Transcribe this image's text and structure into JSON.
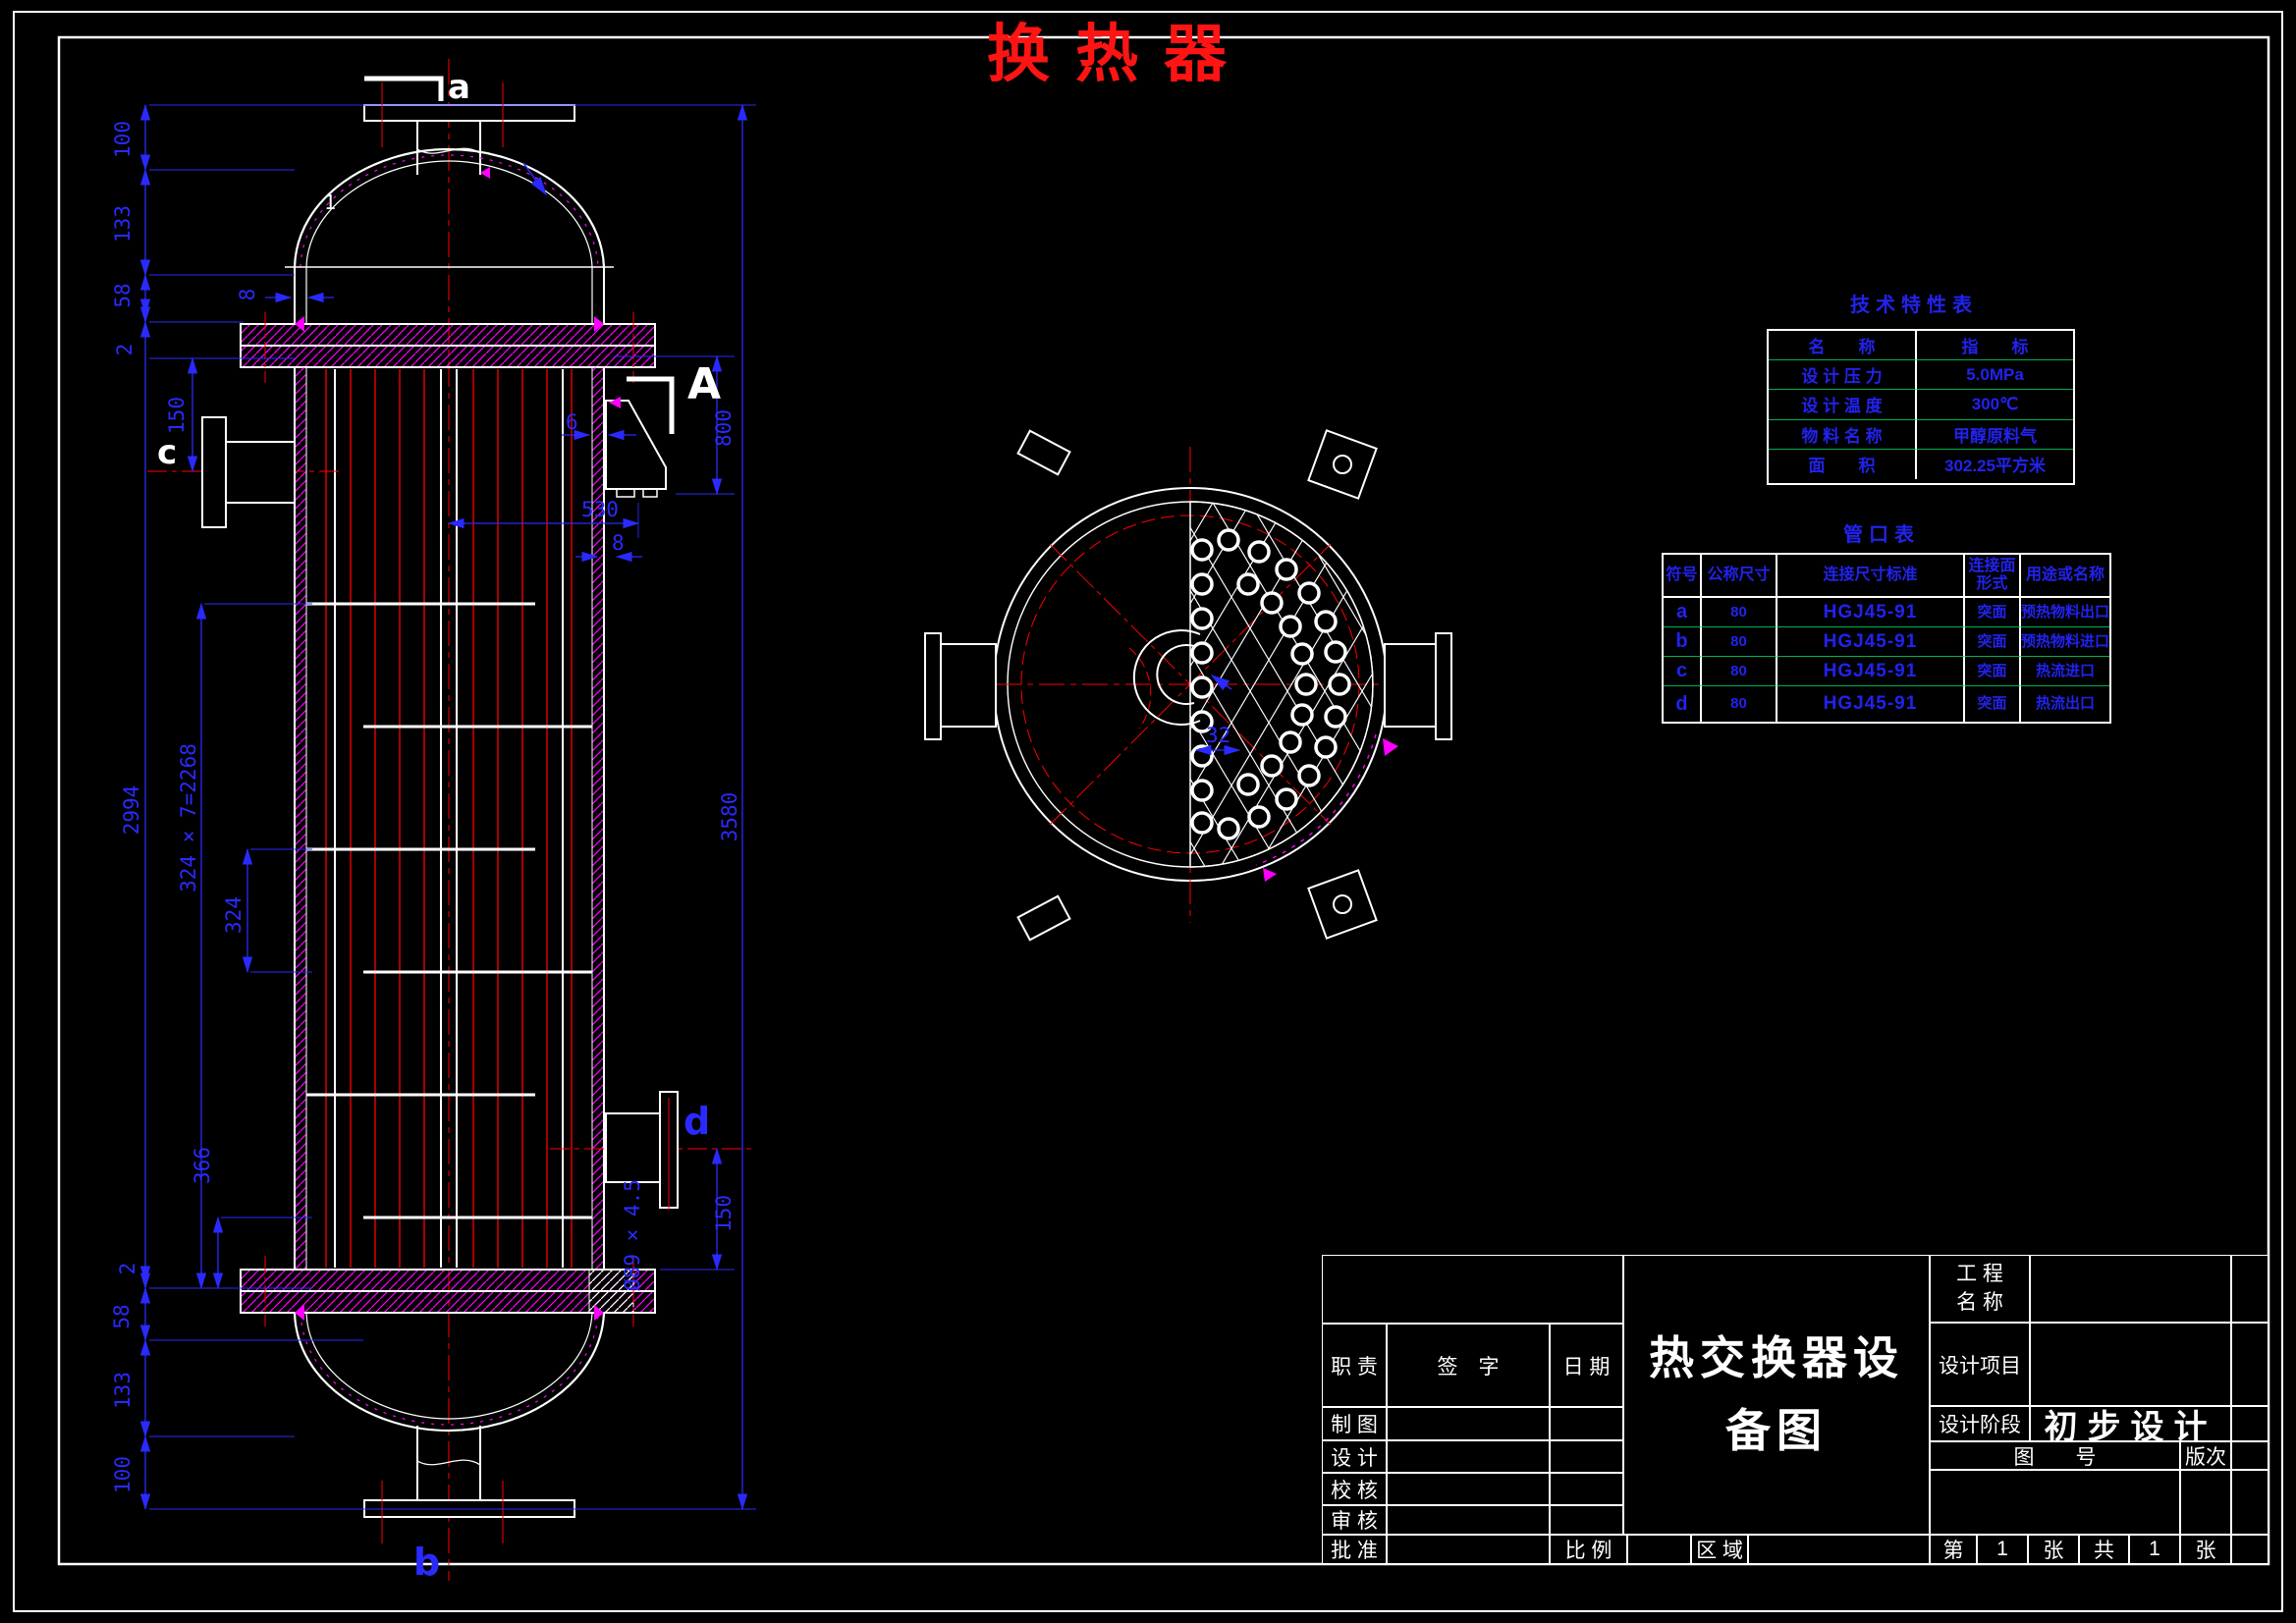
{
  "page_title": "换热器",
  "colors": {
    "line": "#ffffff",
    "dimension": "#2a2aff",
    "centerline": "#ff0000",
    "hatch": "#ff00ff",
    "table_grid": "#00b050",
    "main_title": "#ff1414",
    "table_text": "#2222ee"
  },
  "tech_table": {
    "title": "技术特性表",
    "col_headers": [
      "名　　称",
      "指　　标"
    ],
    "rows": [
      [
        "设 计 压 力",
        "5.0MPa"
      ],
      [
        "设 计 温 度",
        "300℃"
      ],
      [
        "物 料 名 称",
        "甲醇原料气"
      ],
      [
        "面　　积",
        "302.25平方米"
      ]
    ]
  },
  "nozzle_table": {
    "title": "管口表",
    "col_headers": [
      "符号",
      "公称尺寸",
      "连接尺寸标准",
      "连接面形式",
      "用途或名称"
    ],
    "rows": [
      [
        "a",
        "80",
        "HGJ45-91",
        "突面",
        "预热物料出口"
      ],
      [
        "b",
        "80",
        "HGJ45-91",
        "突面",
        "预热物料进口"
      ],
      [
        "c",
        "80",
        "HGJ45-91",
        "突面",
        "热流进口"
      ],
      [
        "d",
        "80",
        "HGJ45-91",
        "突面",
        "热流出口"
      ]
    ]
  },
  "title_block": {
    "duty_label": "职 责",
    "sign_label": "签　字",
    "date_label": "日 期",
    "roles": [
      "制 图",
      "设 计",
      "校 核",
      "审 核",
      "批 准"
    ],
    "title_line1": "热交换器设",
    "title_line2": "备图",
    "scale_label": "比 例",
    "zone_label": "区 域",
    "sheet_no_label": "第",
    "sheet_no": "1",
    "sheet_no_unit": "张",
    "sheet_total_label": "共",
    "sheet_total": "1",
    "sheet_total_unit": "张",
    "project_name_label_1": "工 程",
    "project_name_label_2": "名 称",
    "design_project_label": "设计项目",
    "design_stage_label": "设计阶段",
    "design_stage_value": "初步设计",
    "drawing_number_label": "图　　号",
    "version_label": "版次"
  },
  "front_view": {
    "label_a": "a",
    "label_b": "b",
    "label_c": "c",
    "label_d": "d",
    "section_label": "A",
    "weld_mark": "1",
    "dim_top_100": "100",
    "dim_top_133": "133",
    "dim_top_58": "58",
    "dim_top_2": "2",
    "dim_c_150": "150",
    "dim_shell_2994": "2994",
    "dim_baffles_total": "324 × 7=2268",
    "dim_baffle_pitch": "324",
    "dim_366": "366",
    "dim_bot_2": "2",
    "dim_bot_58": "58",
    "dim_bot_133": "133",
    "dim_bot_100": "100",
    "dim_total_3580": "3580",
    "dim_bracket_800": "800",
    "dim_bracket_530": "530",
    "dim_wall_6": "6",
    "dim_wall_8": "8",
    "dim_flange_8": "8",
    "dim_d_pipe": "Ø89 × 4.5",
    "dim_d_150": "150"
  },
  "section_view": {
    "tube_pitch_dim": "32"
  }
}
